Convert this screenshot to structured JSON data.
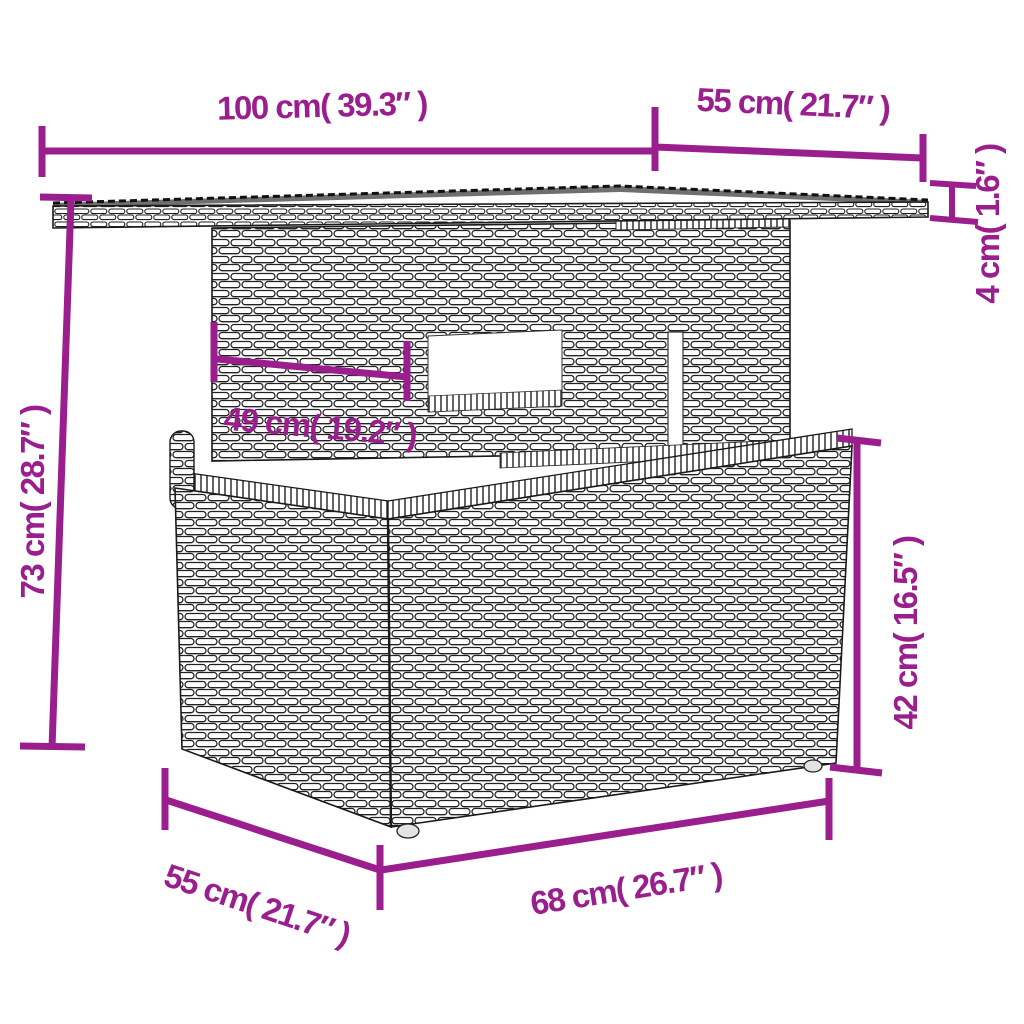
{
  "meta": {
    "type": "product-dimension-diagram",
    "subject": "poly-rattan garden table",
    "view": "front-left perspective line drawing"
  },
  "style": {
    "accent_color": "#9B1E8E",
    "outline_color": "#1a1a1a",
    "tabletop_surface_color": "#6f6f6f",
    "background_color": "#ffffff"
  },
  "dimensions": {
    "top_width": {
      "label": "100 cm( 39.3″ )",
      "value_cm": 100,
      "value_in": 39.3,
      "part": "tabletop width"
    },
    "top_depth": {
      "label": "55 cm( 21.7″ )",
      "value_cm": 55,
      "value_in": 21.7,
      "part": "tabletop depth"
    },
    "tabletop_thickness": {
      "label": "4 cm( 1.6″ )",
      "value_cm": 4,
      "value_in": 1.6,
      "part": "tabletop thickness"
    },
    "total_height": {
      "label": "73 cm( 28.7″ )",
      "value_cm": 73,
      "value_in": 28.7,
      "part": "total height"
    },
    "pedestal_width": {
      "label": "49 cm( 19.2″ )",
      "value_cm": 49,
      "value_in": 19.2,
      "part": "pedestal width"
    },
    "base_height": {
      "label": "42 cm( 16.5″ )",
      "value_cm": 42,
      "value_in": 16.5,
      "part": "base height"
    },
    "base_depth": {
      "label": "55 cm( 21.7″ )",
      "value_cm": 55,
      "value_in": 21.7,
      "part": "base depth"
    },
    "base_width": {
      "label": "68 cm( 26.7″ )",
      "value_cm": 68,
      "value_in": 26.7,
      "part": "base width"
    }
  }
}
